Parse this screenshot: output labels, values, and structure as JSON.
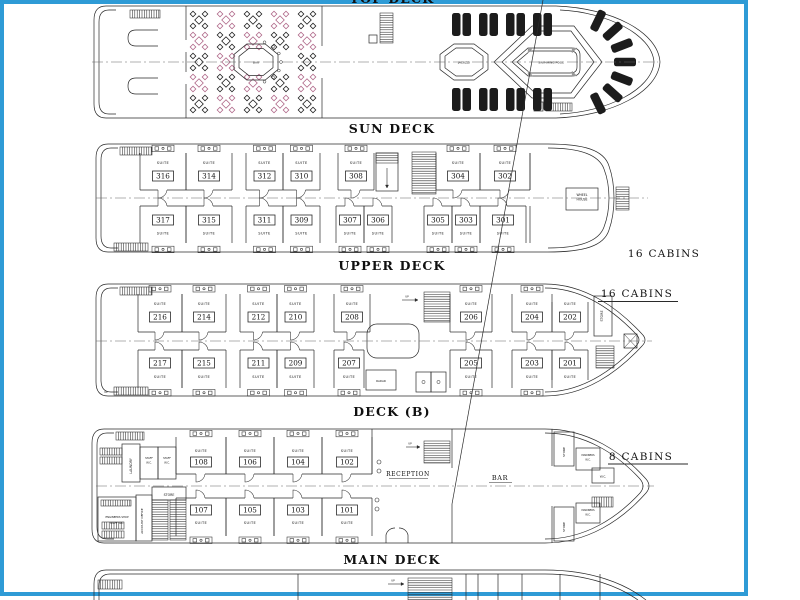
{
  "frame_color": "#2e9bd6",
  "line_color": "#2a2a2a",
  "accent_pink": "#b06a8a",
  "top_partial_caption": "TOP DECK",
  "suite_label": "SUITE",
  "up_label": "UP",
  "captions": {
    "sun": "SUN DECK",
    "upper": "UPPER DECK",
    "b": "DECK (B)",
    "main": "MAIN DECK"
  },
  "sun_deck": {
    "bar": "BAR",
    "jacuzzi": "JACUZZI",
    "pool": "SWIMMING POOL"
  },
  "upper_deck": {
    "count": "16 CABINS",
    "wheel_house": [
      "WHEEL",
      "HOUSE"
    ],
    "cabins_top": [
      "316",
      "314",
      "312",
      "310",
      "308",
      "304",
      "302"
    ],
    "cabins_bottom": [
      "317",
      "315",
      "311",
      "309",
      "307",
      "306",
      "305",
      "303",
      "301"
    ]
  },
  "deck_b": {
    "count": "16 CABINS",
    "store": "STORE",
    "radar": "RADAR",
    "cabins_top": [
      "216",
      "214",
      "212",
      "210",
      "208",
      "206",
      "204",
      "202"
    ],
    "cabins_bottom": [
      "217",
      "215",
      "211",
      "209",
      "207",
      "205",
      "203",
      "201"
    ]
  },
  "main_deck": {
    "count": "8 CABINS",
    "laundry": "LAUNDRY",
    "staff_wc": [
      "STAFF",
      "W.C."
    ],
    "reception": "RECEPTION",
    "bar": "BAR",
    "store": "STORE",
    "mariners_wc": [
      "MARINERS",
      "W.C."
    ],
    "wc": "W.C.",
    "engineers": [
      "ENGINEERS SHOP",
      "STAFF W.C."
    ],
    "account_office": "ACCOUNT OFFICE",
    "cabins_top": [
      "108",
      "106",
      "104",
      "102"
    ],
    "cabins_bottom": [
      "107",
      "105",
      "103",
      "101"
    ]
  }
}
